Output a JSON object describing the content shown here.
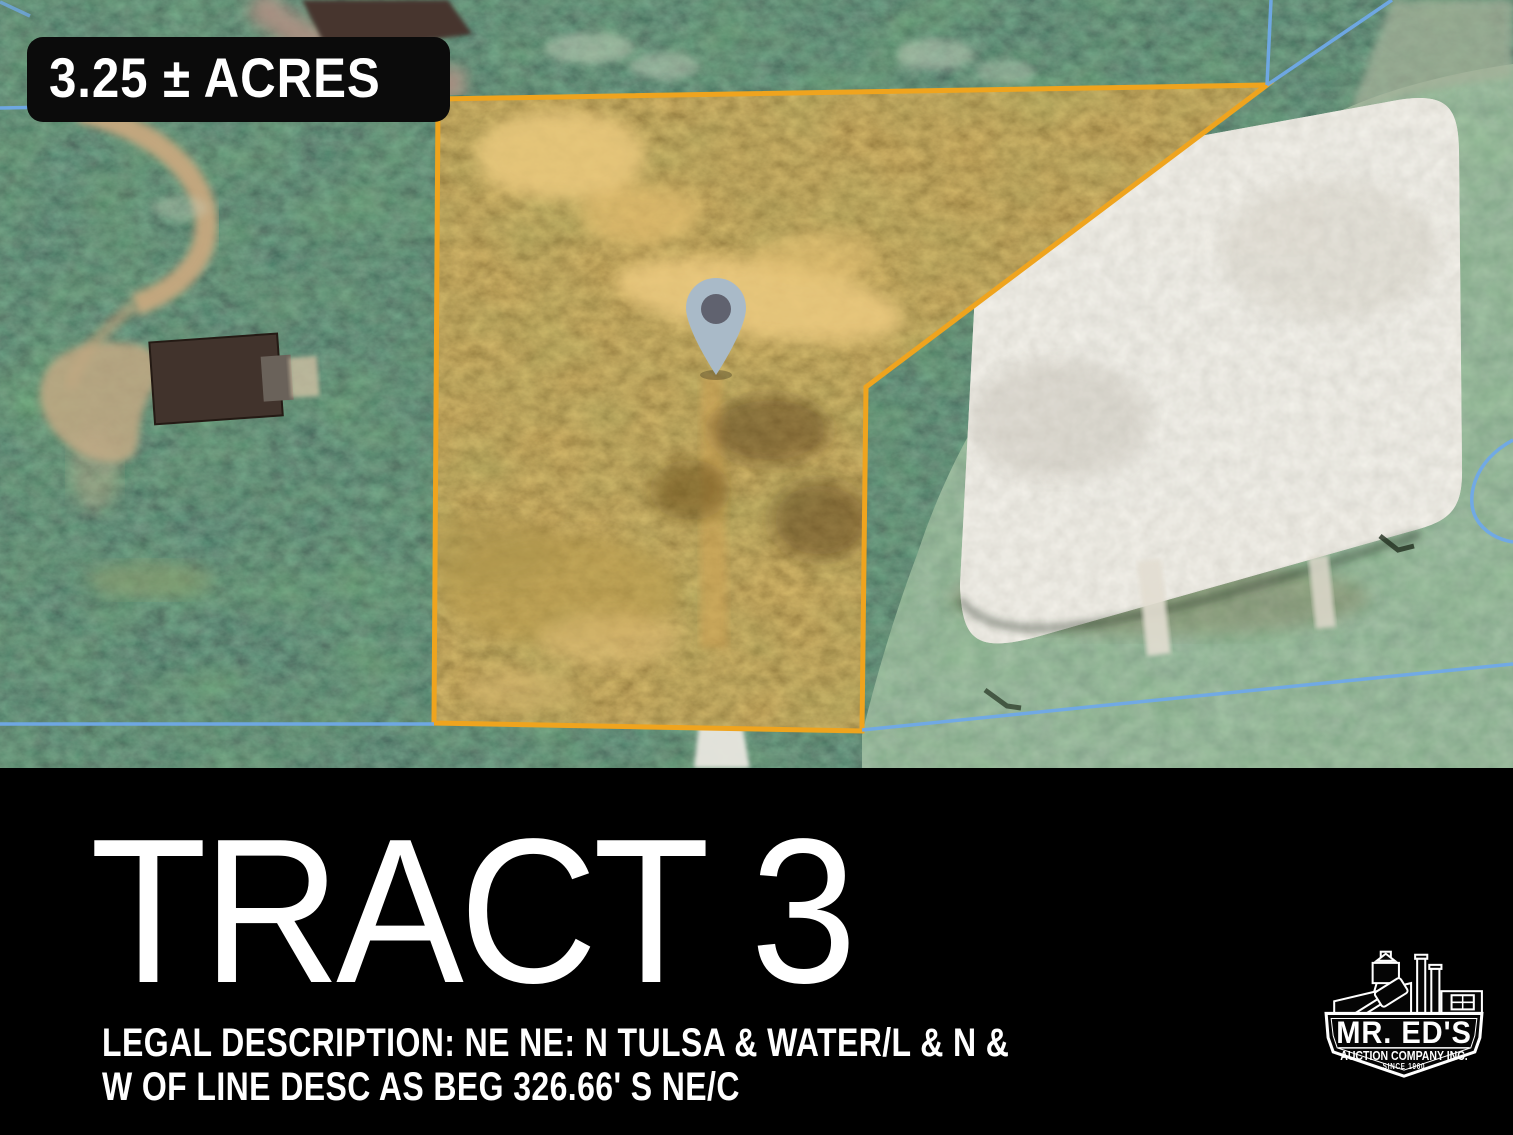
{
  "map": {
    "acreage_label": "3.25 ± ACRES",
    "tract": {
      "boundary_color": "#EFA41E",
      "fill_tint": "rgba(226,158,48,0.18)"
    },
    "parcel_line_color": "#6FA9E8",
    "pin": {
      "body_color": "#A9BAC8",
      "dot_color": "#60626F"
    }
  },
  "banner": {
    "background": "#000000",
    "title": "TRACT 3",
    "legal_line1": "LEGAL DESCRIPTION: NE NE: N TULSA & WATER/L & N &",
    "legal_line2": "W OF LINE DESC AS BEG 326.66' S NE/C"
  },
  "logo": {
    "name": "MR. ED'S",
    "subtitle": "AUCTION COMPANY INC.",
    "since": "SINCE 1960"
  },
  "icons": {
    "map_pin": "map-pin-icon",
    "auction_logo": "auction-company-logo"
  }
}
